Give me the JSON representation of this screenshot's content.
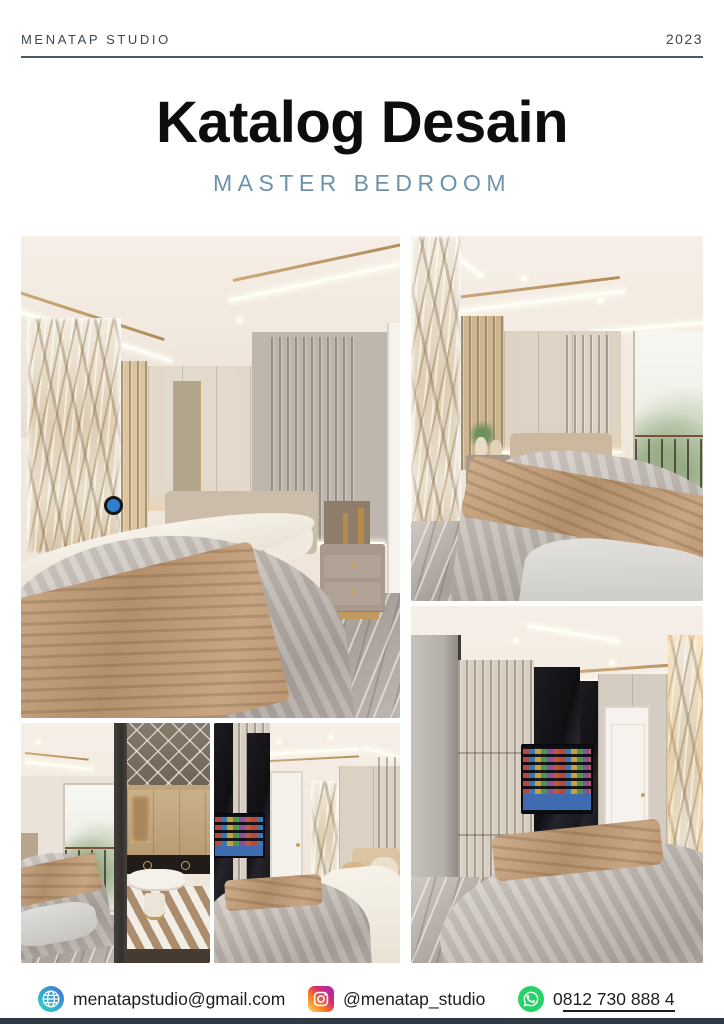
{
  "header": {
    "studio": "MENATAP STUDIO",
    "year": "2023"
  },
  "title": {
    "main": "Katalog Desain",
    "subtitle": "MASTER BEDROOM"
  },
  "gallery": {
    "items": [
      {
        "alt": "Master bedroom render - bed with marble accent wall, slat panels and nightstand"
      },
      {
        "alt": "Master bedroom render - bed with brown throw beside window with garden view"
      },
      {
        "alt": "Master bedroom render - view of bed and walk-in wardrobe with vanity"
      },
      {
        "alt": "Master bedroom render - bed facing TV cabinet and white door"
      },
      {
        "alt": "Master bedroom render - TV wall, wardrobe, white door and marble strip"
      }
    ]
  },
  "footer": {
    "email": {
      "icon": "globe-icon",
      "label": "menatapstudio@gmail.com"
    },
    "instagram": {
      "icon": "instagram-icon",
      "label": "@menatap_studio"
    },
    "whatsapp": {
      "icon": "whatsapp-icon",
      "prefix": "0",
      "number": "812 730 888 4"
    }
  },
  "colors": {
    "subtitle": "#6d92ac",
    "header_rule": "#47586a",
    "bottom_bar": "#2e3944",
    "whatsapp": "#25d366",
    "instagram_gradient": [
      "#feda75",
      "#fa7e1e",
      "#d62976",
      "#962fbf"
    ],
    "globe_gradient": [
      "#2fd6c3",
      "#3f72d9"
    ]
  }
}
